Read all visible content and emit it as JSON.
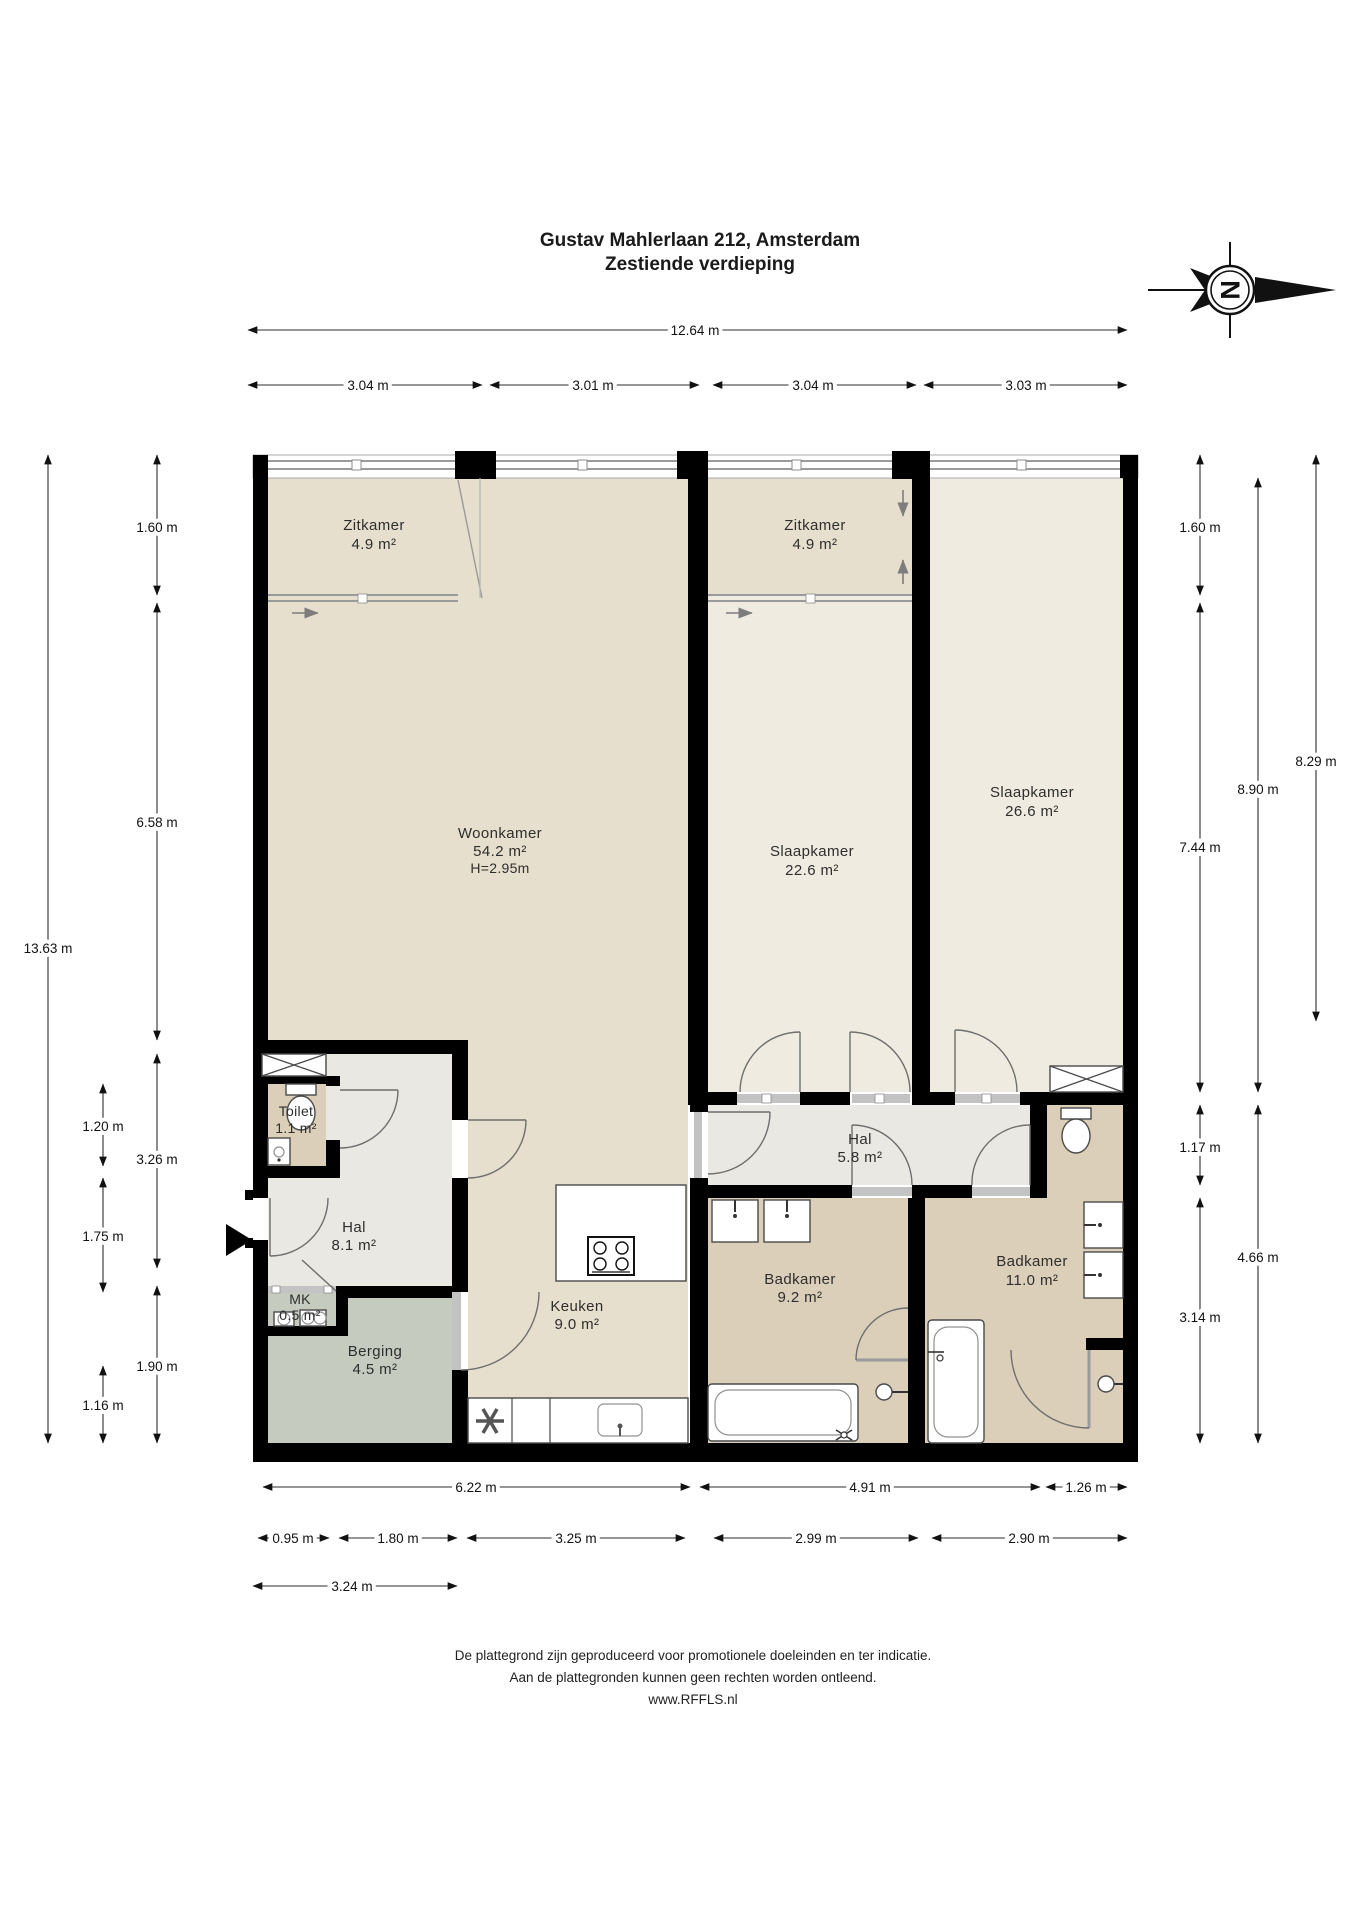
{
  "title": {
    "line1": "Gustav Mahlerlaan 212, Amsterdam",
    "line2": "Zestiende verdieping"
  },
  "compass": {
    "north_letter": "N"
  },
  "rooms": {
    "zitkamer_left": {
      "name": "Zitkamer",
      "area": "4.9 m²"
    },
    "zitkamer_right": {
      "name": "Zitkamer",
      "area": "4.9 m²"
    },
    "woonkamer": {
      "name": "Woonkamer",
      "area": "54.2 m²",
      "ceiling_height": "H=2.95m"
    },
    "slaapkamer_1": {
      "name": "Slaapkamer",
      "area": "22.6 m²"
    },
    "slaapkamer_2": {
      "name": "Slaapkamer",
      "area": "26.6 m²"
    },
    "toilet": {
      "name": "Toilet",
      "area": "1.1 m²"
    },
    "hal_1": {
      "name": "Hal",
      "area": "8.1 m²"
    },
    "hal_2": {
      "name": "Hal",
      "area": "5.8 m²"
    },
    "mk": {
      "name": "MK",
      "area": "0.5 m²"
    },
    "berging": {
      "name": "Berging",
      "area": "4.5 m²"
    },
    "keuken": {
      "name": "Keuken",
      "area": "9.0 m²"
    },
    "badkamer_1": {
      "name": "Badkamer",
      "area": "9.2 m²"
    },
    "badkamer_2": {
      "name": "Badkamer",
      "area": "11.0 m²"
    }
  },
  "dimensions": {
    "top_total": "12.64 m",
    "top_segments": [
      "3.04 m",
      "3.01 m",
      "3.04 m",
      "3.03 m"
    ],
    "left_total": "13.63 m",
    "left_rail_b": [
      "1.60 m",
      "6.58 m",
      "3.26 m",
      "1.90 m"
    ],
    "left_rail_c": [
      "1.20 m",
      "1.75 m",
      "1.16 m"
    ],
    "right_rail_a": [
      "1.60 m",
      "7.44 m",
      "1.17 m",
      "3.14 m"
    ],
    "right_rail_b": [
      "8.90 m",
      "4.66 m"
    ],
    "right_rail_c": [
      "8.29 m"
    ],
    "bottom_row1": [
      "6.22 m",
      "4.91 m",
      "1.26 m"
    ],
    "bottom_row2": [
      "0.95 m",
      "1.80 m",
      "3.25 m",
      "2.99 m",
      "2.90 m"
    ],
    "bottom_row3": [
      "3.24 m"
    ]
  },
  "footer": {
    "line1": "De plattegrond zijn geproduceerd voor promotionele doeleinden en ter indicatie.",
    "line2": "Aan de plattegronden kunnen geen rechten worden ontleend.",
    "line3": "www.RFFLS.nl"
  },
  "colors": {
    "wall": "#000000",
    "floor_living": "#e7dfce",
    "floor_bedroom": "#efebe0",
    "floor_bathroom": "#dccfba",
    "floor_hall": "#eae8e2",
    "floor_storage": "#c6cbc0"
  }
}
